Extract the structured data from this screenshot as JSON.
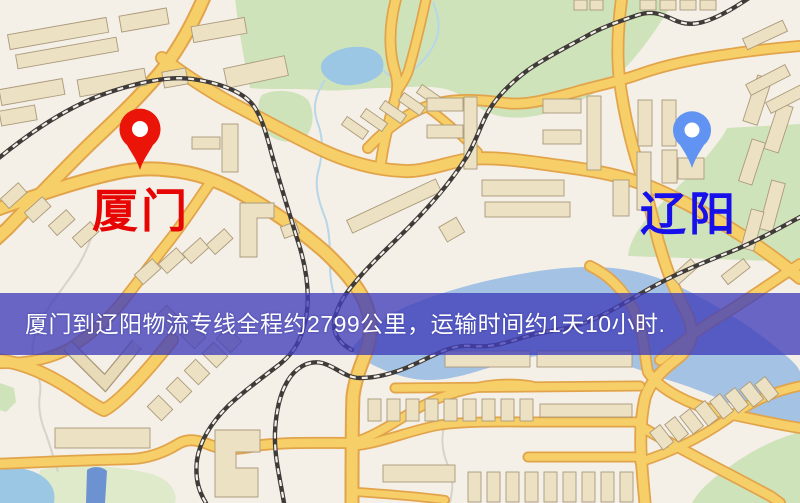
{
  "map_labels": {
    "origin": "厦门",
    "destination": "辽阳"
  },
  "banner": {
    "text": "厦门到辽阳物流专线全程约2799公里，运输时间约1天10小时.",
    "origin": "厦门",
    "destination": "辽阳",
    "distance": "约2799公里",
    "duration": "约1天10小时"
  },
  "icons": {
    "origin_pin": "red-map-pin-icon",
    "destination_pin": "blue-map-pin-icon"
  },
  "colors": {
    "origin_label": "#e60502",
    "destination_label": "#1710ea",
    "origin_pin": "#ea1508",
    "destination_pin": "#6093f2",
    "banner": "#403eba",
    "road": "#f7cf68",
    "road_casing": "#e2a44b",
    "water": "#9cc7e4",
    "park": "#cfe3ba",
    "building": "#ece1c2",
    "railway": "#3f3b38",
    "background": "#f4efe7"
  }
}
